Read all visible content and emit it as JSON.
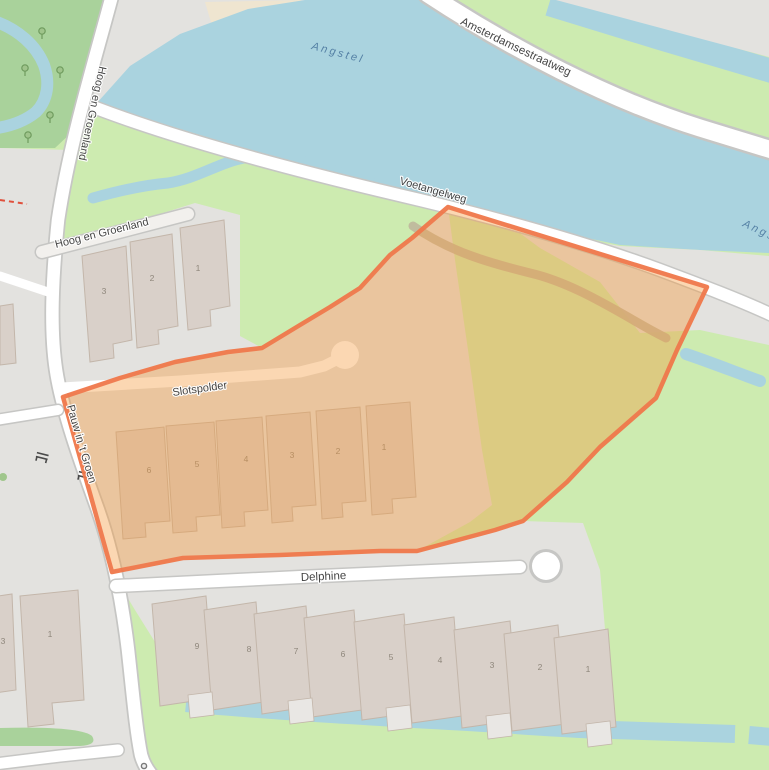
{
  "map_type": "street-map-with-highlighted-parcel",
  "labels": {
    "hoog_en_groenland": "Hoog en Groenland",
    "amsterdamsestraatweg": "Amsterdamsestraatweg",
    "voetangelweg": "Voetangelweg",
    "pauw_in_t_groen": "Pauw in 't Groen",
    "slotspolder": "Slotspolder",
    "delphine": "Delphine",
    "angstel": "Angstel"
  },
  "house_numbers": {
    "hoog_en_groenland": [
      {
        "label": "3",
        "x": 104,
        "y": 294
      },
      {
        "label": "2",
        "x": 152,
        "y": 281
      },
      {
        "label": "1",
        "x": 198,
        "y": 271
      }
    ],
    "slotspolder": [
      {
        "label": "6",
        "x": 149,
        "y": 473
      },
      {
        "label": "5",
        "x": 197,
        "y": 467
      },
      {
        "label": "4",
        "x": 246,
        "y": 462
      },
      {
        "label": "3",
        "x": 292,
        "y": 458
      },
      {
        "label": "2",
        "x": 338,
        "y": 454
      },
      {
        "label": "1",
        "x": 384,
        "y": 450
      }
    ],
    "delphine": [
      {
        "label": "9",
        "x": 197,
        "y": 649
      },
      {
        "label": "8",
        "x": 249,
        "y": 652
      },
      {
        "label": "7",
        "x": 296,
        "y": 654
      },
      {
        "label": "6",
        "x": 343,
        "y": 657
      },
      {
        "label": "5",
        "x": 391,
        "y": 660
      },
      {
        "label": "4",
        "x": 440,
        "y": 663
      },
      {
        "label": "3",
        "x": 492,
        "y": 668
      },
      {
        "label": "2",
        "x": 540,
        "y": 670
      },
      {
        "label": "1",
        "x": 588,
        "y": 672
      }
    ],
    "other": [
      {
        "label": "1",
        "x": 50,
        "y": 637
      },
      {
        "label": "3",
        "x": 3,
        "y": 644
      }
    ]
  },
  "colors": {
    "grass": "#cdebb0",
    "park": "#a9d29b",
    "water": "#aad3df",
    "residential": "#e3e2df",
    "bank": "#efe5d0",
    "road": "#ffffff",
    "road_casing": "#c6c6c4",
    "path_road": "#f2f0ed",
    "track": "#bdb49b",
    "building": "#d9d0c9",
    "building_stroke": "#c3b6aa",
    "porch": "#e9e7e4",
    "highlight_fill": "rgba(244,153,60,0.42)",
    "highlight_stroke": "#f0784a",
    "boundary_red": "#e0503c",
    "label": "#3c3c3c",
    "water_label": "#5581a5",
    "number": "#8f877c",
    "bench": "#4a4a4a",
    "tree": "#6f9b5e"
  }
}
